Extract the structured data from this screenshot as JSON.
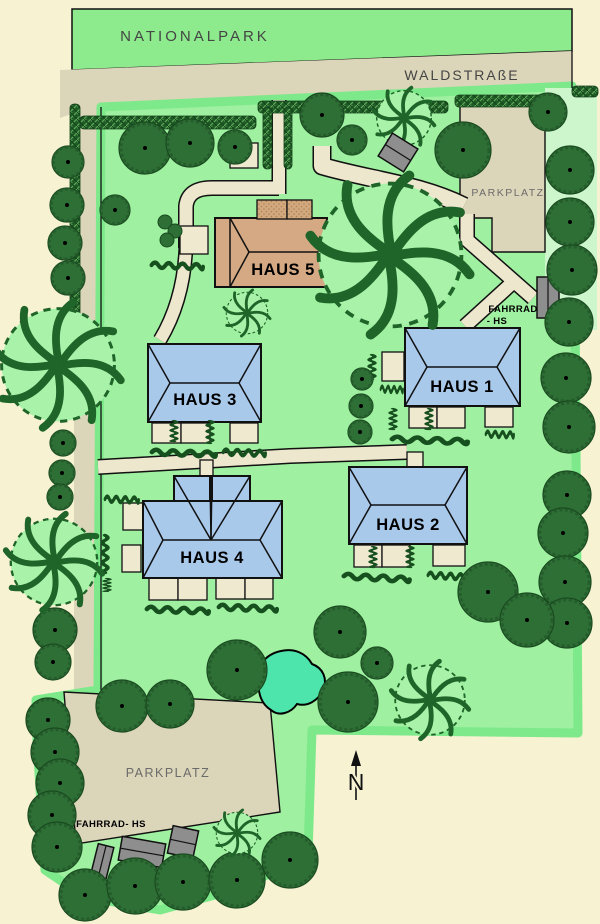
{
  "labels": {
    "nationalpark": "NATIONALPARK",
    "waldstrasse": "WALDSTRAßE",
    "parkplatz_top": "PARKPLATZ",
    "parkplatz_bottom": "PARKPLATZ",
    "fahrrad_top_line1": "FAHRRAD",
    "fahrrad_top_line2": "- HS",
    "fahrrad_bottom": "FAHRRAD- HS",
    "north": "N"
  },
  "colors": {
    "cream": "#F7F2D2",
    "band": "#8DEB8D",
    "road": "#DBD5B9",
    "park": "#9FF0A0",
    "parkedge": "#7DE98B",
    "pale": "#CDF6CD",
    "pathbeige": "#EDE7CD",
    "patio": "#EFE9D0",
    "blue": "#A9C9EB",
    "tan": "#D4A983",
    "tree": "#2E6F35",
    "hedge": "#1E5B26",
    "pond": "#4DE5AC",
    "gray": "#8E8E8E"
  },
  "map": {
    "houses": [
      {
        "name": "haus-5",
        "label": "HAUS 5",
        "cls": "tan",
        "x": 215,
        "y": 218,
        "w": 112,
        "h": 69,
        "lx": 283,
        "ly": 275,
        "parts": [
          [
            257,
            200,
            30,
            19,
            "dormer"
          ],
          [
            287,
            200,
            25,
            19,
            "dormer"
          ]
        ],
        "roof": [
          [
            230,
            218,
            230,
            287
          ],
          [
            230,
            218,
            249,
            252
          ],
          [
            230,
            287,
            249,
            252
          ],
          [
            249,
            252,
            327,
            252
          ]
        ]
      },
      {
        "name": "haus-1",
        "label": "HAUS 1",
        "cls": "blue",
        "x": 405,
        "y": 328,
        "w": 115,
        "h": 78,
        "lx": 462,
        "ly": 392,
        "roof": [
          [
            405,
            328,
            427,
            367
          ],
          [
            405,
            406,
            427,
            367
          ],
          [
            520,
            328,
            497,
            367
          ],
          [
            520,
            406,
            497,
            367
          ],
          [
            427,
            367,
            497,
            367
          ]
        ]
      },
      {
        "name": "haus-3",
        "label": "HAUS 3",
        "cls": "blue",
        "x": 148,
        "y": 344,
        "w": 113,
        "h": 78,
        "lx": 205,
        "ly": 405,
        "roof": [
          [
            148,
            344,
            170,
            383
          ],
          [
            148,
            422,
            170,
            383
          ],
          [
            261,
            344,
            239,
            383
          ],
          [
            261,
            422,
            239,
            383
          ],
          [
            170,
            383,
            239,
            383
          ]
        ]
      },
      {
        "name": "haus-2",
        "label": "HAUS 2",
        "cls": "blue",
        "x": 349,
        "y": 467,
        "w": 118,
        "h": 77,
        "lx": 408,
        "ly": 530,
        "roof": [
          [
            349,
            467,
            371,
            505
          ],
          [
            349,
            544,
            371,
            505
          ],
          [
            467,
            467,
            445,
            505
          ],
          [
            467,
            544,
            445,
            505
          ],
          [
            371,
            505,
            445,
            505
          ]
        ]
      },
      {
        "name": "haus-4",
        "label": "HAUS 4",
        "cls": "blue",
        "x": 143,
        "y": 501,
        "w": 139,
        "h": 77,
        "lx": 212,
        "ly": 563,
        "parts": [
          [
            174,
            476,
            36,
            25,
            "blue"
          ],
          [
            212,
            476,
            38,
            25,
            "blue"
          ]
        ],
        "roof": [
          [
            143,
            501,
            163,
            540
          ],
          [
            143,
            578,
            163,
            540
          ],
          [
            282,
            501,
            260,
            540
          ],
          [
            282,
            578,
            260,
            540
          ],
          [
            163,
            540,
            260,
            540
          ],
          [
            174,
            476,
            211,
            540
          ],
          [
            210,
            476,
            211,
            540
          ],
          [
            212,
            476,
            211,
            540
          ],
          [
            250,
            476,
            211,
            540
          ]
        ]
      }
    ],
    "patios": [
      [
        152,
        423,
        29,
        20
      ],
      [
        181,
        423,
        29,
        20
      ],
      [
        230,
        423,
        28,
        20
      ],
      [
        382,
        352,
        22,
        29
      ],
      [
        409,
        407,
        28,
        21
      ],
      [
        437,
        407,
        28,
        21
      ],
      [
        485,
        407,
        28,
        20
      ],
      [
        354,
        545,
        28,
        22
      ],
      [
        382,
        545,
        28,
        22
      ],
      [
        433,
        545,
        32,
        21
      ],
      [
        149,
        578,
        29,
        22
      ],
      [
        178,
        578,
        29,
        22
      ],
      [
        216,
        578,
        29,
        21
      ],
      [
        245,
        578,
        28,
        21
      ],
      [
        123,
        503,
        20,
        27
      ],
      [
        122,
        545,
        19,
        27
      ],
      [
        180,
        226,
        28,
        28
      ],
      [
        230,
        143,
        28,
        25
      ],
      [
        407,
        452,
        16,
        16
      ],
      [
        200,
        460,
        13,
        18
      ]
    ],
    "paths": [
      {
        "d": "M279,100 L279,194",
        "w": 12
      },
      {
        "d": "M279,188 L212,188 Q188,188 186,206 L186,248",
        "w": 13
      },
      {
        "d": "M186,246 Q184,300 160,340",
        "w": 12
      },
      {
        "d": "M322,146 L322,166 C370,180 420,184 464,206",
        "w": 16
      },
      {
        "d": "M98,467 L290,456 L407,452",
        "w": 13
      },
      {
        "d": "M467,214 L467,240 L533,298",
        "w": 13
      },
      {
        "d": "M510,285 L465,326",
        "w": 13
      }
    ],
    "hedge_strips": [
      [
        80,
        116,
        176,
        13
      ],
      [
        258,
        101,
        190,
        12
      ],
      [
        455,
        95,
        106,
        12
      ],
      [
        572,
        86,
        26,
        11
      ],
      [
        70,
        104,
        10,
        246
      ],
      [
        263,
        107,
        9,
        62
      ],
      [
        284,
        107,
        8,
        62
      ]
    ],
    "hedge_squiggles": [
      [
        150,
        447,
        68,
        2
      ],
      [
        222,
        447,
        45,
        2
      ],
      [
        179,
        420,
        22,
        90
      ],
      [
        215,
        420,
        24,
        90
      ],
      [
        398,
        408,
        22,
        90
      ],
      [
        434,
        408,
        22,
        90
      ],
      [
        390,
        434,
        80,
        2
      ],
      [
        485,
        429,
        30,
        2
      ],
      [
        377,
        354,
        26,
        90
      ],
      [
        380,
        384,
        24,
        2
      ],
      [
        378,
        546,
        22,
        90
      ],
      [
        415,
        546,
        22,
        90
      ],
      [
        342,
        571,
        70,
        3
      ],
      [
        427,
        570,
        40,
        3
      ],
      [
        104,
        494,
        36,
        2
      ],
      [
        110,
        534,
        40,
        90
      ],
      [
        112,
        578,
        14,
        90
      ],
      [
        145,
        604,
        66,
        2
      ],
      [
        217,
        602,
        62,
        2
      ],
      [
        150,
        260,
        55,
        2
      ]
    ],
    "trees_dark": [
      [
        145,
        148,
        26
      ],
      [
        190,
        143,
        24
      ],
      [
        235,
        147,
        17
      ],
      [
        115,
        210,
        15
      ],
      [
        322,
        115,
        22
      ],
      [
        352,
        140,
        15
      ],
      [
        463,
        150,
        28
      ],
      [
        548,
        112,
        19
      ],
      [
        570,
        170,
        24
      ],
      [
        570,
        222,
        24
      ],
      [
        572,
        270,
        25
      ],
      [
        569,
        322,
        24
      ],
      [
        566,
        378,
        25
      ],
      [
        569,
        427,
        26
      ],
      [
        567,
        495,
        24
      ],
      [
        563,
        533,
        25
      ],
      [
        565,
        582,
        26
      ],
      [
        567,
        623,
        25
      ],
      [
        362,
        379,
        11
      ],
      [
        361,
        406,
        12
      ],
      [
        360,
        432,
        12
      ],
      [
        237,
        670,
        30
      ],
      [
        340,
        632,
        26
      ],
      [
        348,
        702,
        30
      ],
      [
        377,
        663,
        16
      ],
      [
        488,
        592,
        30
      ],
      [
        527,
        620,
        27
      ],
      [
        68,
        162,
        16
      ],
      [
        67,
        205,
        17
      ],
      [
        65,
        243,
        17
      ],
      [
        68,
        278,
        17
      ],
      [
        63,
        443,
        13
      ],
      [
        62,
        473,
        13
      ],
      [
        60,
        497,
        13
      ],
      [
        55,
        630,
        22
      ],
      [
        53,
        662,
        18
      ],
      [
        48,
        720,
        22
      ],
      [
        55,
        752,
        24
      ],
      [
        60,
        783,
        24
      ],
      [
        52,
        815,
        24
      ],
      [
        57,
        847,
        25
      ],
      [
        122,
        706,
        26
      ],
      [
        170,
        704,
        24
      ],
      [
        85,
        895,
        26
      ],
      [
        135,
        886,
        28
      ],
      [
        183,
        882,
        28
      ],
      [
        237,
        880,
        28
      ],
      [
        290,
        860,
        28
      ]
    ],
    "trees_swirl": [
      [
        390,
        255,
        76
      ],
      [
        58,
        365,
        60
      ],
      [
        54,
        562,
        46
      ],
      [
        404,
        118,
        29
      ],
      [
        247,
        313,
        22
      ],
      [
        237,
        833,
        22
      ],
      [
        430,
        700,
        37
      ]
    ],
    "bushes": [
      [
        165,
        222,
        7
      ],
      [
        175,
        231,
        7
      ],
      [
        167,
        240,
        7
      ]
    ],
    "shelters": [
      {
        "x": 537,
        "y": 277,
        "w": 22,
        "h": 41,
        "rot": 0,
        "line": "v",
        "late": false
      },
      {
        "x": 93,
        "y": 845,
        "w": 16,
        "h": 42,
        "rot": 14,
        "line": "v",
        "late": false
      },
      {
        "x": 120,
        "y": 840,
        "w": 44,
        "h": 24,
        "rot": 10,
        "line": "h",
        "late": false
      },
      {
        "x": 170,
        "y": 828,
        "w": 26,
        "h": 28,
        "rot": 12,
        "line": "h",
        "late": false
      },
      {
        "x": 383,
        "y": 139,
        "w": 30,
        "h": 27,
        "rot": 32,
        "line": "h",
        "late": true
      }
    ],
    "pond": {
      "d": "M258,684 C255,666 266,654 281,651 C294,648 306,653 312,664 C323,668 328,679 323,690 C318,701 307,707 297,704 C291,713 279,717 271,710 C261,704 259,694 258,684 Z"
    }
  }
}
